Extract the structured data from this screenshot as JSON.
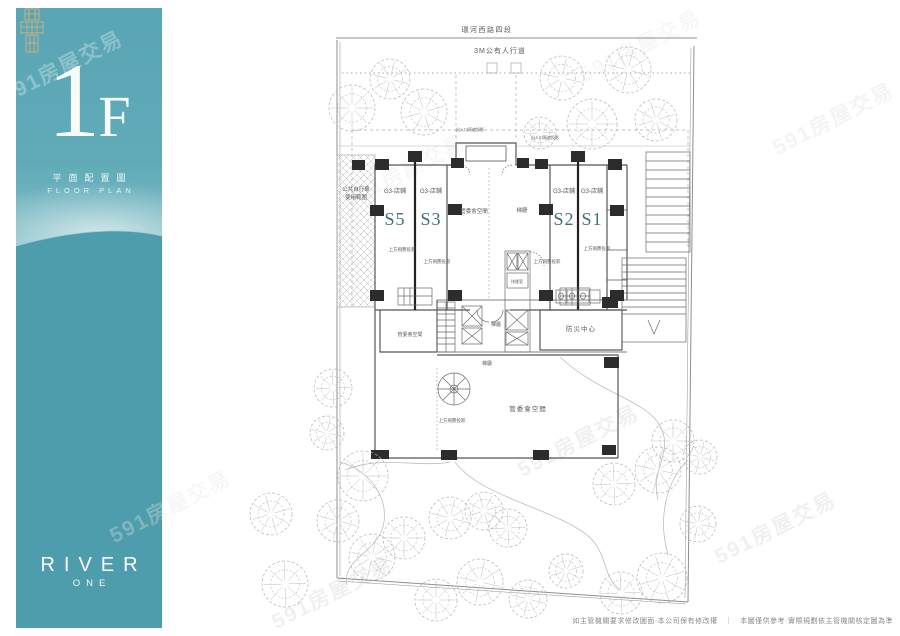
{
  "watermark_text": "591房屋交易",
  "sidebar": {
    "floor_number": "1",
    "floor_suffix": "F",
    "subtitle_zh": "平面配置圖",
    "subtitle_en": "FLOOR PLAN",
    "brand_name": "RIVER",
    "brand_sub": "ONE"
  },
  "plan": {
    "road_label": "環河西路四段",
    "sidewalk_label": "3M公有人行道",
    "bike_area_line1": "公共自行車",
    "bike_area_line2": "使用範圍",
    "units": [
      {
        "code": "S5",
        "label": "G3-店鋪"
      },
      {
        "code": "S3",
        "label": "G3-店鋪"
      },
      {
        "code": "S2",
        "label": "G3-店鋪"
      },
      {
        "code": "S1",
        "label": "G3-店鋪"
      }
    ],
    "rooms": {
      "mgmt_office": "管委會空間",
      "elevator_hall": "梯廳",
      "disaster_center": "防災中心",
      "smoke_room": "排煙室"
    },
    "annotations": {
      "eave_projection": "上方飛簷投影",
      "canopy_projection": "出入口雨遮投影"
    }
  },
  "footer": {
    "disclaimer": "如主管機關要求修改圖面·本公司保有修改權　｜　本圖僅供參考·實際規劃依主管機關核定圖為準"
  },
  "colors": {
    "teal_top": "#58a5b5",
    "teal_bottom": "#4e9dad",
    "gold": "#c8b183",
    "unit_label": "#3f6d80"
  }
}
